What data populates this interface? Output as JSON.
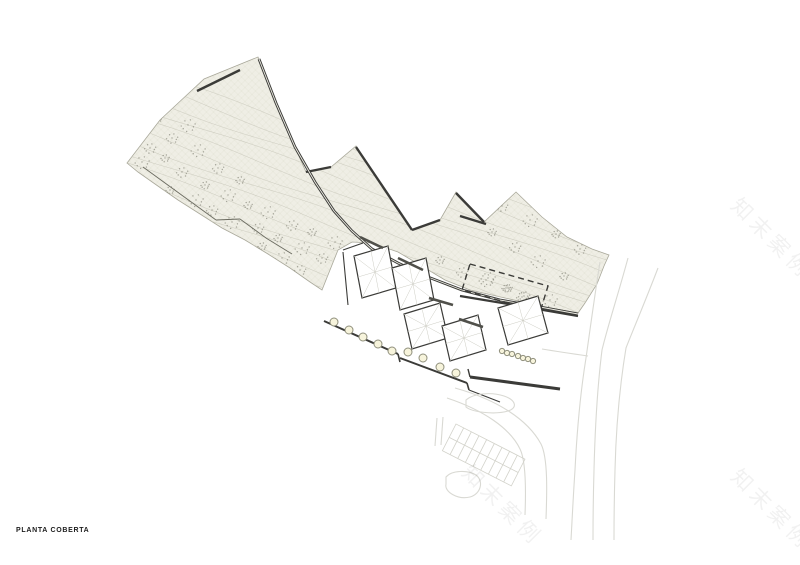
{
  "page": {
    "width": 800,
    "height": 565,
    "background": "#ffffff"
  },
  "title_block": {
    "label": "PLANTA COBERTA"
  },
  "watermarks": [
    {
      "text": "知末案例",
      "cx": 772,
      "cy": 236,
      "rotation": 45
    },
    {
      "text": "知末案例",
      "cx": 503,
      "cy": 503,
      "rotation": 45
    },
    {
      "text": "知末案例",
      "cx": 772,
      "cy": 507,
      "rotation": 45
    }
  ],
  "drawing": {
    "colors": {
      "terrain_fill": "#efeee5",
      "mesh": "#ddddcf",
      "contour": "#c9c8bb",
      "terrain_edge": "#a9a89a",
      "dark": "#3b3b38",
      "mid": "#50504a",
      "thin": "#6b6b60",
      "roof_inner": "#cdcdc4",
      "road": "#d9d9d3",
      "parking": "#d2d2ca",
      "circle_stroke": "#8f8f7c",
      "circle_fill": "#f7f4dc",
      "vegetation": "#6b6b5f",
      "white": "#ffffff"
    },
    "terrain_outline": "127,163 160,120 204,79 258,57 276,103 295,147 306,172 331,167 356,146 412,230 440,220 456,192 484,222 516,192 542,217 567,237 592,249 609,255 604,266 597,284 585,303 578,313 545,307 505,298 470,290 445,280 420,265 398,252 372,243 352,242 338,250 330,270 322,290 310,282 290,268 268,254 245,240 222,228 200,214 178,200 155,184 138,172",
    "sawtooth_walls": [
      "197,91 240,70",
      "306,172 331,167",
      "356,147 412,230",
      "412,230 440,220",
      "456,193 484,222",
      "460,216 486,224"
    ],
    "main_path": "259,59 276,103 295,147 315,182 334,211 352,231 372,249 398,263 428,277 462,290 500,300 540,307 578,314",
    "bottom_wall": "460,296 520,306 578,316",
    "site_wall": "470,377 560,389",
    "site_wall_tick": "470,377 468,369",
    "zigzag_path": [
      "143,167 216,220",
      "216,220 240,219",
      "240,219 266,238 292,254"
    ],
    "terrace_edges": [
      "343,252 348,305",
      "343,250 363,243",
      "469,390 500,402"
    ],
    "stair_walls": [
      "324,321 398,354",
      "400,358 467,383"
    ],
    "wall_ticks": [
      "398,354 400,362",
      "467,383 469,390"
    ],
    "roofs": [
      [
        [
          354,
          256
        ],
        [
          388,
          246
        ],
        [
          396,
          288
        ],
        [
          362,
          298
        ]
      ],
      [
        [
          392,
          268
        ],
        [
          426,
          258
        ],
        [
          434,
          300
        ],
        [
          400,
          310
        ]
      ],
      [
        [
          404,
          314
        ],
        [
          440,
          303
        ],
        [
          448,
          338
        ],
        [
          412,
          349
        ]
      ],
      [
        [
          442,
          326
        ],
        [
          478,
          315
        ],
        [
          486,
          350
        ],
        [
          450,
          361
        ]
      ],
      [
        [
          498,
          308
        ],
        [
          538,
          296
        ],
        [
          548,
          333
        ],
        [
          508,
          345
        ]
      ]
    ],
    "dashed_roof": [
      [
        470,
        264
      ],
      [
        548,
        286
      ],
      [
        540,
        312
      ],
      [
        462,
        290
      ]
    ],
    "skylight_rows": [
      {
        "r": 4,
        "points": [
          [
            334,
            322
          ],
          [
            349,
            330
          ],
          [
            363,
            337
          ],
          [
            378,
            344
          ],
          [
            392,
            351
          ]
        ]
      },
      {
        "r": 4,
        "points": [
          [
            408,
            352
          ],
          [
            423,
            358
          ],
          [
            440,
            367
          ],
          [
            456,
            373
          ]
        ]
      },
      {
        "r": 2.6,
        "points": [
          [
            502,
            351
          ],
          [
            507,
            353
          ],
          [
            512,
            354
          ],
          [
            518,
            356
          ],
          [
            523,
            358
          ],
          [
            528,
            359
          ],
          [
            533,
            361
          ]
        ]
      }
    ],
    "benches": [
      "360,237 383,248",
      "398,258 423,270",
      "429,298 453,305",
      "459,319 483,327"
    ],
    "roads": [
      "M600,262 C594,300 590,330 586,358 C580,395 577,430 575,470 C573,500 572,522 571,540",
      "M628,258 C618,295 608,325 602,350 C597,390 595,430 594,470 C593,505 593,522 593,540",
      "M658,268 C645,302 633,330 626,348 C619,390 616,430 615,470 C614,505 614,522 614,540",
      "M542,349 C560,352 574,354 588,356",
      "M455,388 C498,400 528,420 541,444 C548,458 547,492 546,519",
      "M447,398 C483,410 510,428 520,449 C526,461 526,490 525,515",
      "M466,400 C474,393 492,392 504,396 C516,400 518,408 508,411 C494,415 472,412 466,407 Z",
      "M446,477 C452,470 468,470 476,475 C484,481 481,494 470,497 C458,500 444,492 446,484 Z",
      "M437,418 L435,446",
      "M443,417 L441,445"
    ],
    "parking": {
      "x": 456,
      "y": 424,
      "rotation": 27,
      "rows": 2,
      "cols": 9,
      "stall_w": 8.6,
      "stall_h": 15
    },
    "vegetation": [
      [
        158,
        118
      ],
      [
        172,
        138
      ],
      [
        188,
        125
      ],
      [
        165,
        158
      ],
      [
        182,
        172
      ],
      [
        198,
        150
      ],
      [
        205,
        185
      ],
      [
        218,
        168
      ],
      [
        228,
        195
      ],
      [
        240,
        180
      ],
      [
        212,
        210
      ],
      [
        232,
        222
      ],
      [
        248,
        205
      ],
      [
        258,
        228
      ],
      [
        268,
        212
      ],
      [
        278,
        238
      ],
      [
        292,
        225
      ],
      [
        302,
        248
      ],
      [
        312,
        232
      ],
      [
        322,
        258
      ],
      [
        335,
        242
      ],
      [
        345,
        262
      ],
      [
        358,
        276
      ],
      [
        370,
        258
      ],
      [
        385,
        272
      ],
      [
        300,
        270
      ],
      [
        282,
        258
      ],
      [
        262,
        246
      ],
      [
        244,
        248
      ],
      [
        196,
        200
      ],
      [
        170,
        190
      ],
      [
        150,
        148
      ],
      [
        142,
        162
      ],
      [
        368,
        254
      ],
      [
        396,
        266
      ],
      [
        418,
        272
      ],
      [
        440,
        260
      ],
      [
        462,
        272
      ],
      [
        486,
        280
      ],
      [
        508,
        288
      ],
      [
        524,
        296
      ],
      [
        550,
        300
      ],
      [
        492,
        232
      ],
      [
        515,
        247
      ],
      [
        538,
        261
      ],
      [
        564,
        276
      ],
      [
        502,
        206
      ],
      [
        530,
        220
      ],
      [
        556,
        234
      ],
      [
        580,
        249
      ],
      [
        488,
        278
      ],
      [
        506,
        288
      ],
      [
        522,
        297
      ]
    ],
    "contours": {
      "count": 18,
      "spacing": 12.5,
      "slope": 0.36,
      "amp": 3.2,
      "wavelen": 46,
      "x_start": 100,
      "x_end": 640,
      "y_start": 55
    }
  }
}
